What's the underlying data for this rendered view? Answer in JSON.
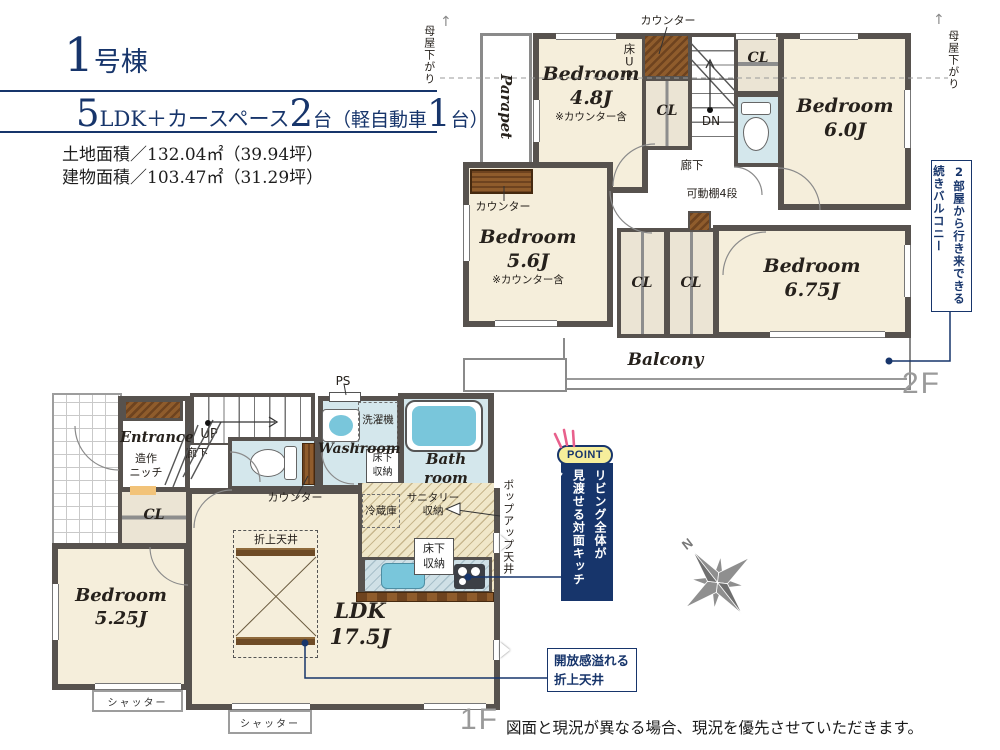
{
  "header": {
    "title_num": "1",
    "title_suffix": "号棟",
    "layout_num1": "5",
    "layout_text1": "LDK＋カースペース",
    "layout_num2": "2",
    "layout_text2": "台（軽自動車",
    "layout_num3": "1",
    "layout_text3": "台）",
    "land_area": "土地面積／132.04㎡（39.94坪）",
    "building_area": "建物面積／103.47㎡（31.29坪）"
  },
  "floor2": {
    "floor_label": "2F",
    "moya_left": "母屋下がり",
    "moya_right": "母屋下がり",
    "parapet": "Parapet",
    "counter_top": "カウンター",
    "yuka_up": "床UP",
    "dn": "DN",
    "hallway": "廊下",
    "shelf": "可動棚4段",
    "counter_left": "カウンター",
    "cl_a": "CL",
    "cl_b": "CL",
    "cl_c": "CL",
    "cl_d": "CL",
    "bedroom_48": {
      "name": "Bedroom",
      "size": "4.8J",
      "note": "※カウンター含"
    },
    "bedroom_60": {
      "name": "Bedroom",
      "size": "6.0J"
    },
    "bedroom_56": {
      "name": "Bedroom",
      "size": "5.6J",
      "note": "※カウンター含"
    },
    "bedroom_675": {
      "name": "Bedroom",
      "size": "6.75J"
    },
    "balcony": "Balcony",
    "callout_balcony_line1": "2部屋から行き来できる",
    "callout_balcony_line2": "続きバルコニー"
  },
  "floor1": {
    "floor_label": "1F",
    "entrance": "Entrance",
    "niche_l1": "造作",
    "niche_l2": "ニッチ",
    "up": "UP",
    "hallway": "廊下",
    "ps": "PS",
    "washer": "洗濯機",
    "washroom": "Washroom",
    "underfloor_wash_l1": "床下",
    "underfloor_wash_l2": "収納",
    "bath_l1": "Bath",
    "bath_l2": "room",
    "counter": "カウンター",
    "cl": "CL",
    "bedroom_525": {
      "name": "Bedroom",
      "size": "5.25J"
    },
    "ldk": {
      "name": "LDK",
      "size": "17.5J"
    },
    "coffered": "折上天井",
    "fridge": "冷蔵庫",
    "sanitary_l1": "サニタリー",
    "sanitary_l2": "収納",
    "underfloor_kitchen_l1": "床下",
    "underfloor_kitchen_l2": "収納",
    "shutter1": "シャッター",
    "shutter2": "シャッター",
    "popup": "ポップアップ天井",
    "point_badge": "POINT",
    "callout_kitchen_line1": "リビング全体が",
    "callout_kitchen_line2": "見渡せる対面キッチン",
    "callout_ceiling_line1": "開放感溢れる",
    "callout_ceiling_line2": "折上天井"
  },
  "compass_n": "N",
  "disclaimer": "図面と現況が異なる場合、現況を優先させていただきます。",
  "colors": {
    "navy": "#17356b",
    "wall": "#57524e",
    "room_cream": "#f5eedb",
    "wet_blue": "#d4e7ec",
    "fixture_blue": "#79c6db",
    "wood_brown": "#6e431f",
    "point_yellow": "#f6ee9b",
    "ray_pink": "#e8608c"
  }
}
